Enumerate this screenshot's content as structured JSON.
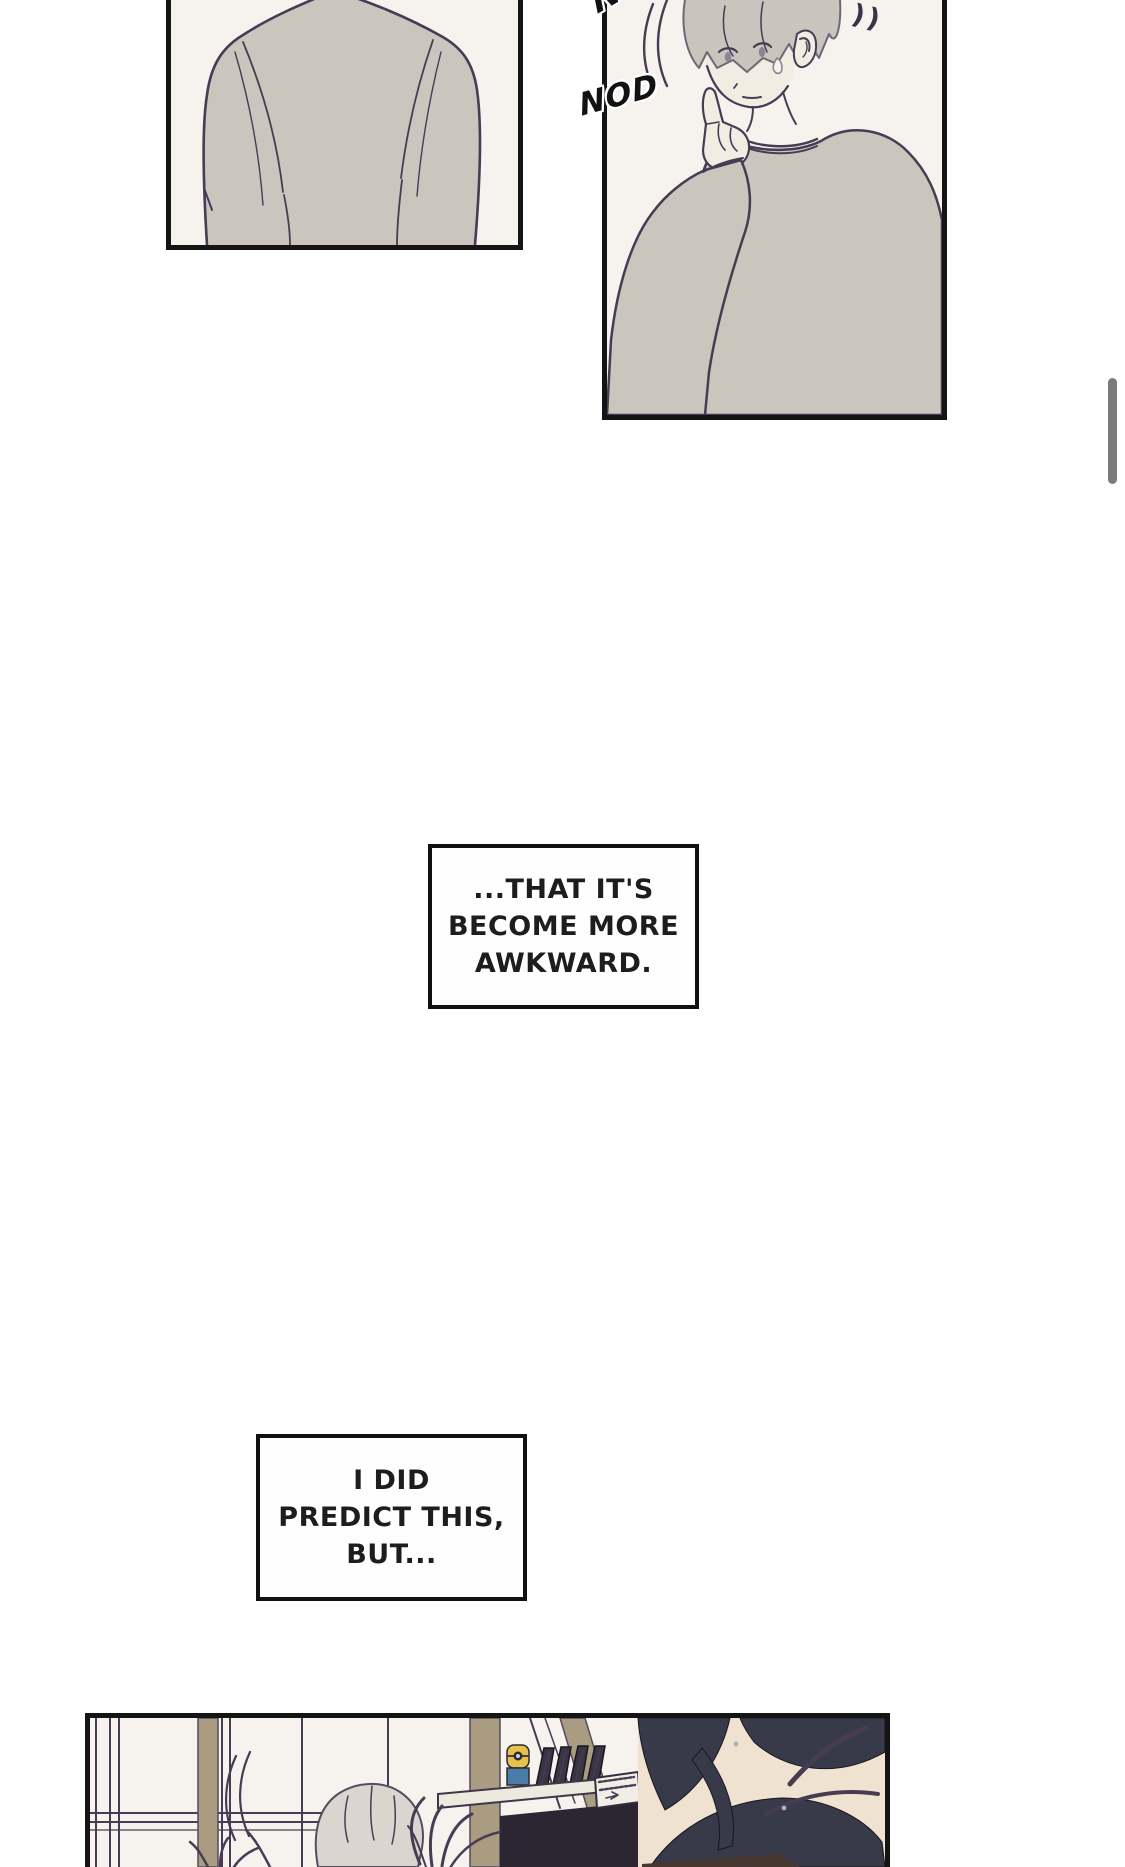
{
  "viewer": {
    "background": "#ffffff",
    "scrollbar_color": "#7b7b7b"
  },
  "sfx": {
    "nod_top": "NOD",
    "nod_mid": "NOD",
    "chime_marks": "))"
  },
  "captions": [
    {
      "lines": [
        "...THAT IT'S",
        "BECOME MORE",
        "AWKWARD."
      ]
    },
    {
      "lines": [
        "I DID",
        "PREDICT THIS,",
        "BUT..."
      ]
    }
  ],
  "colors": {
    "page_bg": "#ffffff",
    "panel_border": "#141414",
    "panel_bg": "#f6f3ee",
    "ink": "#473c54",
    "sweater": "#cac5bd",
    "skin": "#f2ece3",
    "hair_silver": "#c9c4bc",
    "hair_black": "#383a49",
    "wood": "#a99c81",
    "caption_text": "#1d1d1d",
    "scrollbar": "#7b7b7b"
  }
}
